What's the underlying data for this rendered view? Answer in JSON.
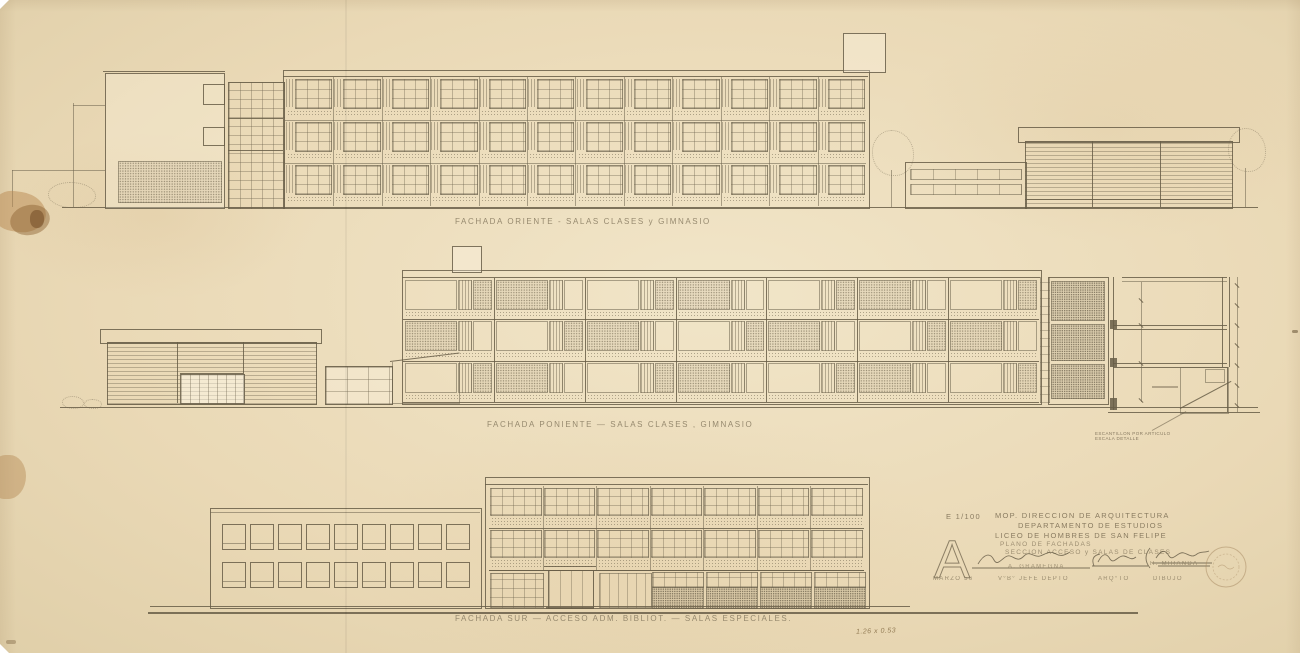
{
  "colors": {
    "paper": "#ebdec0",
    "ink": "#6e644e",
    "stain": "#b08049"
  },
  "elevations": [
    {
      "id": "oriente",
      "caption": "FACHADA ORIENTE - SALAS CLASES y GIMNASIO"
    },
    {
      "id": "poniente",
      "caption": "FACHADA PONIENTE — SALAS CLASES , GIMNASIO"
    },
    {
      "id": "sur",
      "caption": "FACHADA SUR — ACCESO ADM. BIBLIOT. — SALAS ESPECIALES."
    }
  ],
  "title_block": {
    "scale": "E 1/100",
    "sheet_letter": "A",
    "org_line1": "MOP. DIRECCION DE ARQUITECTURA",
    "org_line2": "DEPARTAMENTO DE ESTUDIOS",
    "project": "LICEO DE HOMBRES DE SAN FELIPE",
    "sheet_line1": "PLANO DE FACHADAS",
    "sheet_line2": "SECCION ACCESO y SALAS DE CLASES",
    "date": "MARZO 56",
    "signatories": [
      {
        "name": "A. GRAMEGNA",
        "role": "V°B° JEFE DEPTO"
      },
      {
        "name": "",
        "role": "ARQ°TO"
      },
      {
        "name": "H. MIRANDA",
        "role": "DIBUJO"
      }
    ]
  },
  "annotations": {
    "section_note_line1": "ESCANTILLON POR ARTICULO",
    "section_note_line2": "ESCALA DETALLE",
    "sheet_size_note": "1.26 x 0.53"
  },
  "drawing": {
    "oriente_main": {
      "stories": 3,
      "bays": 12
    },
    "poniente_main": {
      "stories": 3,
      "bays": 7
    },
    "sur_left": {
      "rows": 2,
      "cols": 9
    },
    "sur_right_upper": {
      "stories": 2,
      "bays": 7
    }
  }
}
